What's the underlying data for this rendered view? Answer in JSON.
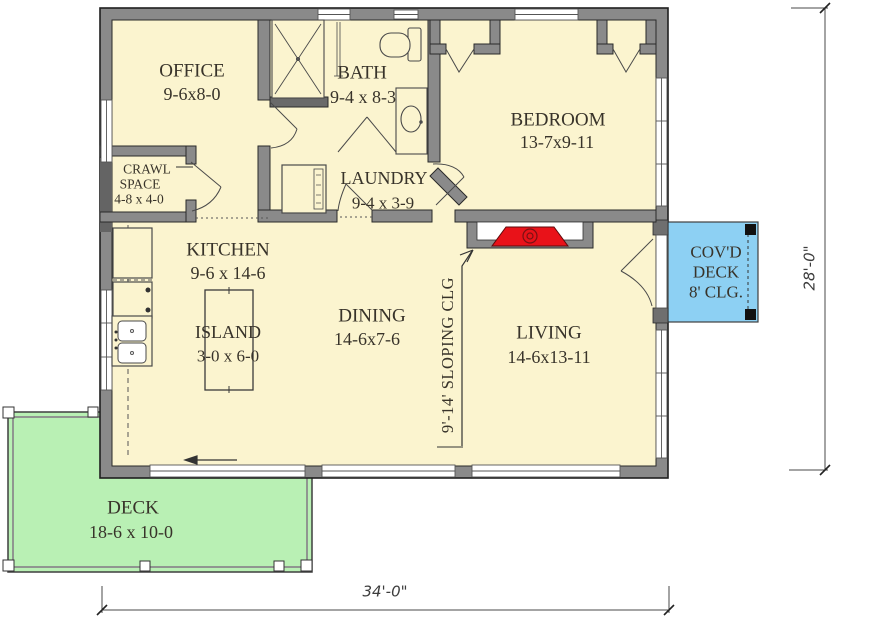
{
  "title": "One-story house floor plan",
  "colors": {
    "floor": "#FBF4CF",
    "wall": "#8a8a8a",
    "deck_green": "#B9F0B4",
    "covered_deck_blue": "#8DD0F3",
    "stove_red": "#E91219",
    "text": "#38332a"
  },
  "rooms": {
    "office": {
      "name": "OFFICE",
      "dims": "9-6x8-0"
    },
    "bath": {
      "name": "BATH",
      "dims": "9-4 x 8-3"
    },
    "crawl_space": {
      "line1": "CRAWL",
      "line2": "SPACE",
      "dims": "4-8 x 4-0"
    },
    "laundry": {
      "name": "LAUNDRY",
      "dims": "9-4 x 3-9"
    },
    "bedroom": {
      "name": "BEDROOM",
      "dims": "13-7x9-11"
    },
    "kitchen": {
      "name": "KITCHEN",
      "dims": "9-6 x 14-6"
    },
    "island": {
      "name": "ISLAND",
      "dims": "3-0 x 6-0"
    },
    "dining": {
      "name": "DINING",
      "dims": "14-6x7-6"
    },
    "living": {
      "name": "LIVING",
      "dims": "14-6x13-11"
    },
    "covered_deck": {
      "line1": "COV'D",
      "line2": "DECK",
      "line3": "8' CLG."
    },
    "deck": {
      "name": "DECK",
      "dims": "18-6 x 10-0"
    }
  },
  "annotations": {
    "sloping_ceiling": "9'-14' SLOPING CLG",
    "overall_width": "34'-0\"",
    "overall_height": "28'-0\""
  }
}
